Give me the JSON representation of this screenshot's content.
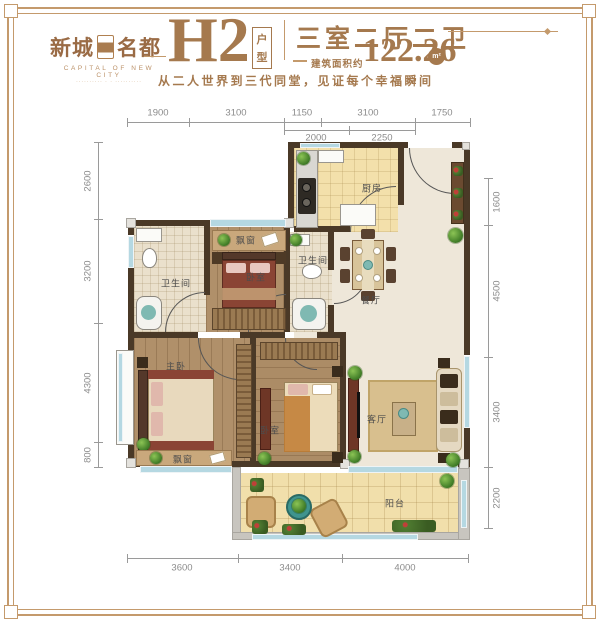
{
  "brand": {
    "name_left": "新城",
    "name_right": "名都",
    "subtitle": "CAPITAL OF NEW CITY",
    "decor_line": "·········· · · ··········"
  },
  "header": {
    "plan_code": "H2",
    "plan_type_char1": "户",
    "plan_type_char2": "型",
    "rooms_title": "三室二厅二卫",
    "area_label": "建筑面积约",
    "area_value": "122.26",
    "area_unit": "m²",
    "slogan": "从二人世界到三代同堂，见证每个幸福瞬间"
  },
  "rooms": {
    "kitchen": "厨房",
    "bathroom": "卫生间",
    "bedroom": "卧室",
    "master_bedroom": "主卧",
    "dining": "餐厅",
    "living": "客厅",
    "balcony": "阳台",
    "bay_window": "飘窗"
  },
  "dimensions": {
    "top_row1": [
      "1900",
      "3100",
      "1150",
      "3100",
      "1750"
    ],
    "top_row2": [
      "2000",
      "2250"
    ],
    "left": [
      "2600",
      "3200",
      "4300",
      "800"
    ],
    "right": [
      "1600",
      "4500",
      "3400",
      "2200"
    ],
    "bottom": [
      "3600",
      "3400",
      "4000"
    ]
  },
  "colors": {
    "accent_brown": "#a5794e",
    "wall": "#4a3927",
    "window_blue": "#b5d8e2"
  }
}
